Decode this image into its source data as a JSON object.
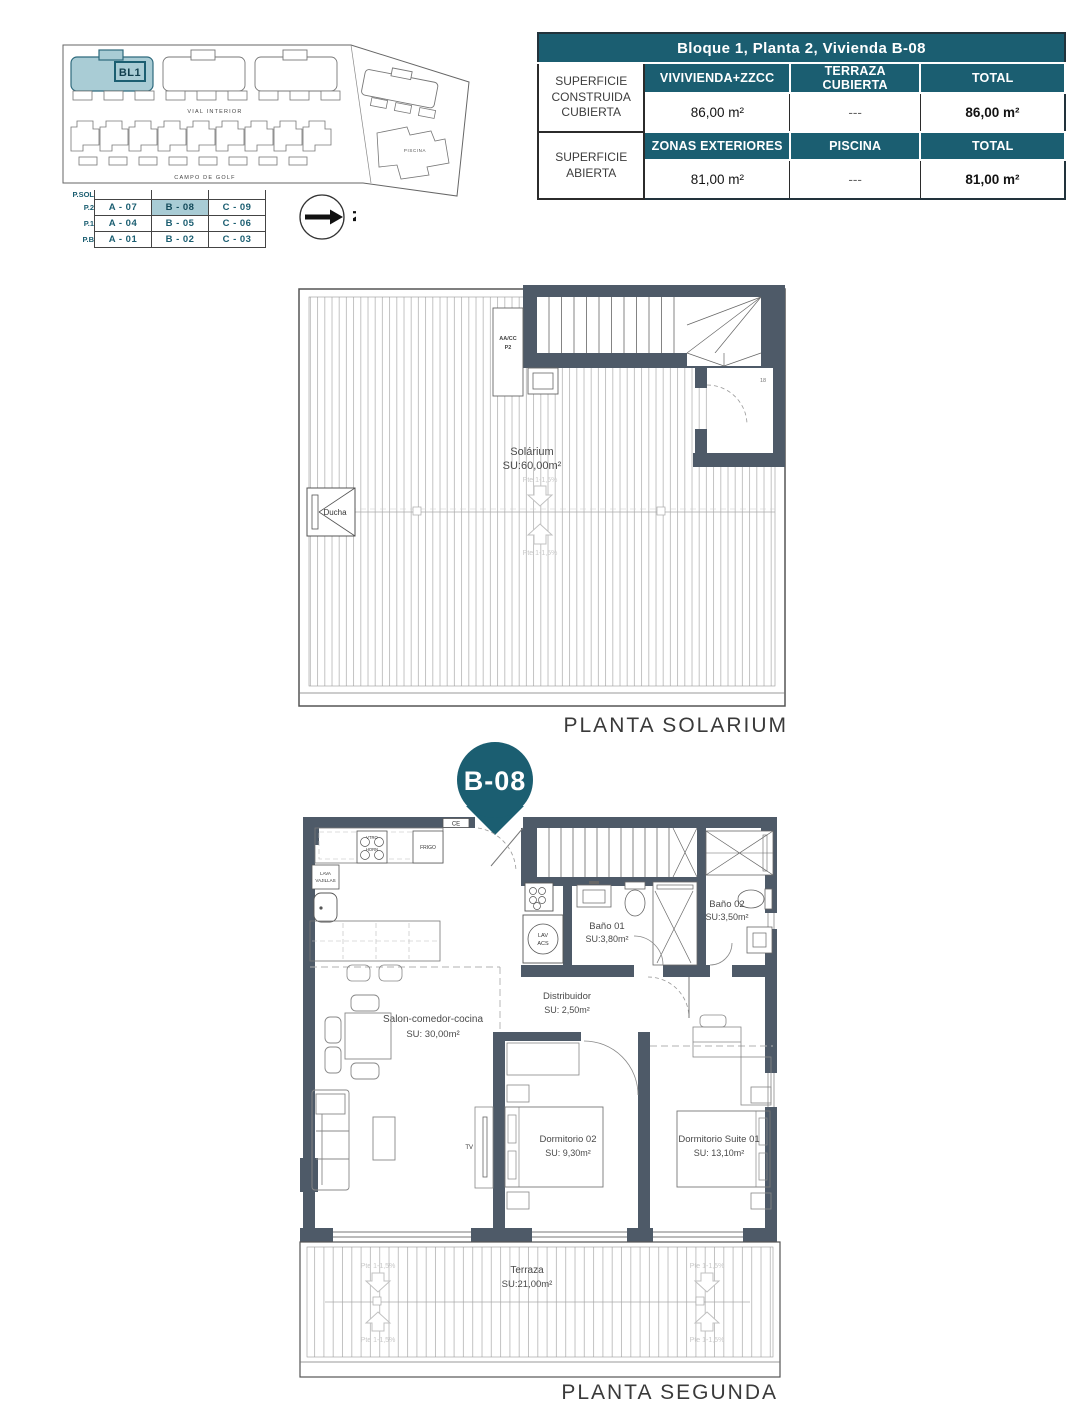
{
  "colors": {
    "accent_teal": "#1b5e71",
    "highlight_teal": "#a9ccd5",
    "wall_gray": "#4e5a68"
  },
  "site_plan": {
    "block_label": "BL1",
    "road_label": "VIAL INTERIOR",
    "golf_label": "CAMPO DE GOLF",
    "pool_label": "PISCINA"
  },
  "north_letter": "N",
  "unit_table": {
    "floor_labels": [
      "P.SOL",
      "P.2",
      "P.1",
      "P.B"
    ],
    "rows": [
      [
        "A - 07",
        "B - 08",
        "C - 09"
      ],
      [
        "A - 04",
        "B - 05",
        "C - 06"
      ],
      [
        "A - 01",
        "B - 02",
        "C - 03"
      ]
    ],
    "highlighted_cell": "B - 08"
  },
  "area_table": {
    "title": "Bloque 1, Planta 2, Vivienda B-08",
    "sections": [
      {
        "label": "SUPERFICIE CONSTRUIDA CUBIERTA",
        "col_headers": [
          "VIVIVIENDA+ZZCC",
          "TERRAZA CUBIERTA",
          "TOTAL"
        ],
        "values": [
          "86,00 m²",
          "---",
          "86,00 m²"
        ]
      },
      {
        "label": "SUPERFICIE ABIERTA",
        "col_headers": [
          "ZONAS EXTERIORES",
          "PISCINA",
          "TOTAL"
        ],
        "values": [
          "81,00 m²",
          "---",
          "81,00 m²"
        ]
      }
    ]
  },
  "solarium": {
    "caption": "PLANTA SOLARIUM",
    "room_name": "Solárium",
    "room_area": "SU:60,00m²",
    "shower_label": "Ducha",
    "ac_line1": "AA/CC",
    "ac_line2": "P2",
    "slope_down": "Pte 1-1,5%",
    "slope_up": "Pte 1-1,5%",
    "stair_count": "18"
  },
  "pin": {
    "label": "B-08"
  },
  "segunda": {
    "caption": "PLANTA SEGUNDA",
    "rooms": {
      "salon": {
        "name": "Salon-comedor-cocina",
        "area": "SU: 30,00m²"
      },
      "distribuidor": {
        "name": "Distribuidor",
        "area": "SU: 2,50m²"
      },
      "bano1": {
        "name": "Baño 01",
        "area": "SU:3,80m²"
      },
      "bano2": {
        "name": "Baño 02",
        "area": "SU:3,50m²"
      },
      "dorm2": {
        "name": "Dormitorio 02",
        "area": "SU: 9,30m²"
      },
      "suite": {
        "name": "Dormitorio Suite 01",
        "area": "SU: 13,10m²"
      },
      "terraza": {
        "name": "Terraza",
        "area": "SU:21,00m²"
      }
    },
    "fixtures": {
      "ce": "CE",
      "vtro": "VTRO",
      "horn": "HORN",
      "frigo": "FRIGO",
      "lava_l1": "LAVA",
      "lava_l2": "VAJILLAS",
      "lav": "LAV",
      "acs": "ACS",
      "tv": "TV"
    },
    "slope_label": "Pte 1-1,5%"
  }
}
